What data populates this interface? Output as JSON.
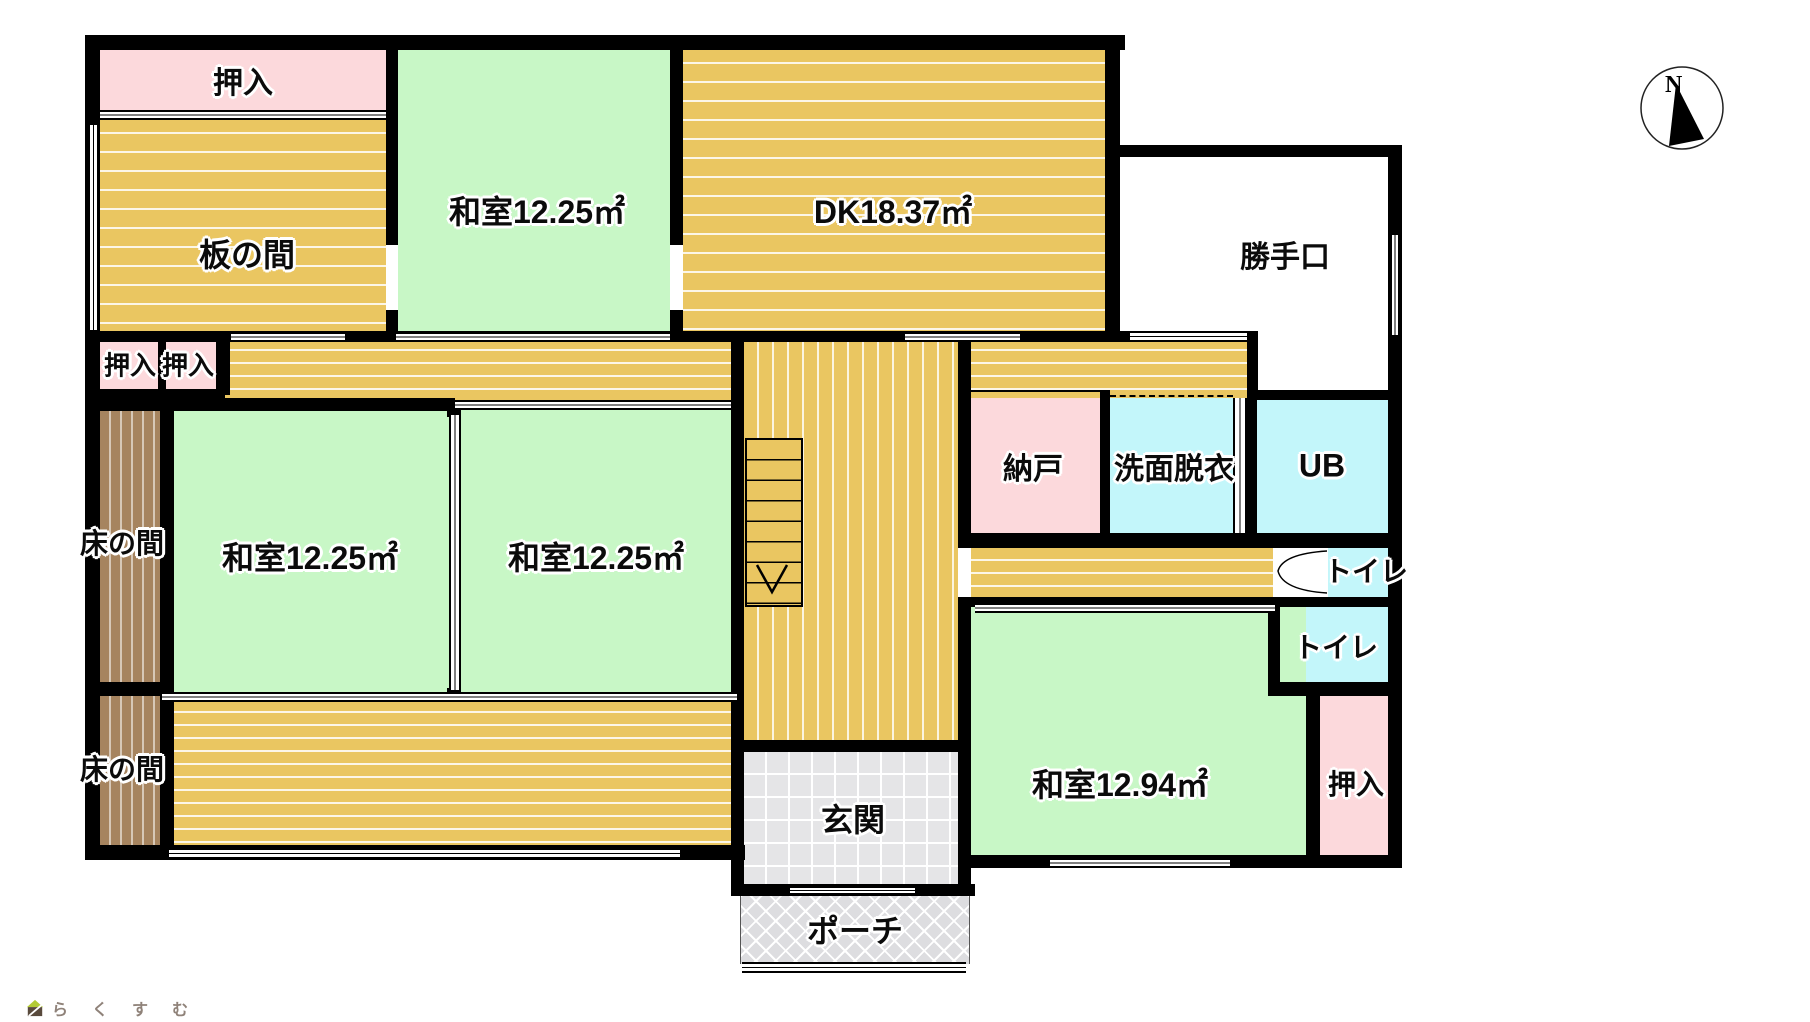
{
  "rooms": {
    "oshiire_top": {
      "label": "押入"
    },
    "itanoma": {
      "label": "板の間"
    },
    "washitsu_top": {
      "label": "和室12.25㎡",
      "area_sqm": 12.25
    },
    "dk": {
      "label": "DK18.37㎡",
      "area_sqm": 18.37
    },
    "katteguchi": {
      "label": "勝手口"
    },
    "oshiire_a": {
      "label": "押入"
    },
    "oshiire_b": {
      "label": "押入"
    },
    "tokonoma_upper": {
      "label": "床の間"
    },
    "washitsu_mid_left": {
      "label": "和室12.25㎡",
      "area_sqm": 12.25
    },
    "washitsu_mid_right": {
      "label": "和室12.25㎡",
      "area_sqm": 12.25
    },
    "nando": {
      "label": "納戸"
    },
    "senmen_datsui": {
      "label": "洗面脱衣"
    },
    "ub": {
      "label": "UB"
    },
    "toilet_upper": {
      "label": "トイレ"
    },
    "toilet_lower": {
      "label": "トイレ"
    },
    "tokonoma_lower": {
      "label": "床の間"
    },
    "washitsu_sw": {
      "label": "和室12.94㎡",
      "area_sqm": 12.94
    },
    "oshiire_se": {
      "label": "押入"
    },
    "genkan": {
      "label": "玄関"
    },
    "porch": {
      "label": "ポーチ"
    }
  },
  "compass": {
    "north_label": "N"
  },
  "branding": {
    "logo_text": "らくすむ"
  },
  "colors": {
    "wall": "#000000",
    "tatami_green": "#c8f7c6",
    "wood_tan": "#eac661",
    "closet_pink": "#fcd9dc",
    "bath_cyan": "#c3f6fa",
    "tokonoma_brown": "#a6845f",
    "entry_gray": "#e5e5e7",
    "porch_gray": "#dddde0"
  }
}
